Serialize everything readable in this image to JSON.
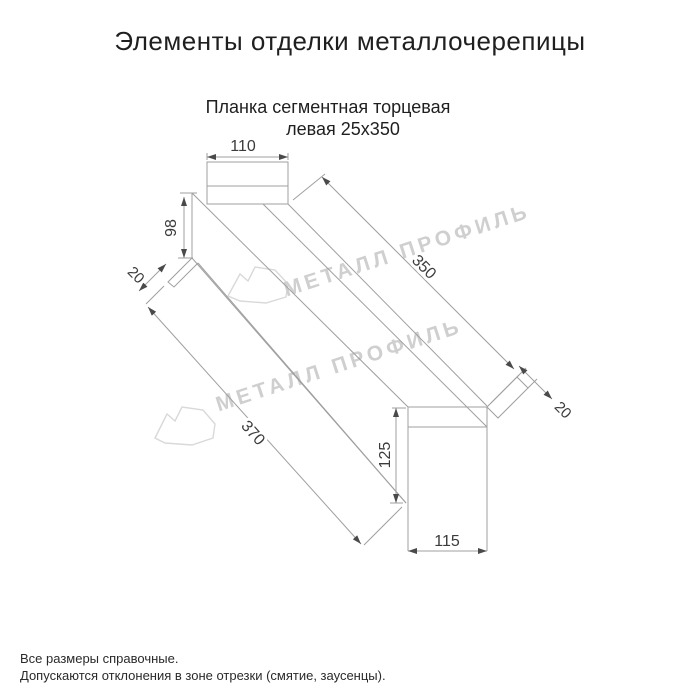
{
  "header": {
    "title": "Элементы отделки металлочерепицы",
    "subtitle_line1": "Планка сегментная торцевая",
    "subtitle_line2": "левая 25х350"
  },
  "dimensions": {
    "top_width": "110",
    "left_height": "98",
    "left_flap": "20",
    "top_edge_length": "350",
    "bottom_edge_length": "370",
    "right_height": "125",
    "bottom_width": "115",
    "right_flap": "20"
  },
  "watermark": {
    "brand": "МЕТАЛЛ ПРОФИЛЬ"
  },
  "footnotes": {
    "line1": "Все размеры справочные.",
    "line2": "Допускаются отклонения в зоне отрезки (смятие, заусенцы)."
  },
  "colors": {
    "line": "#9f9f9f",
    "dim_text": "#3b3b3b",
    "watermark": "#cfcfcf",
    "text": "#1f1f1f"
  }
}
